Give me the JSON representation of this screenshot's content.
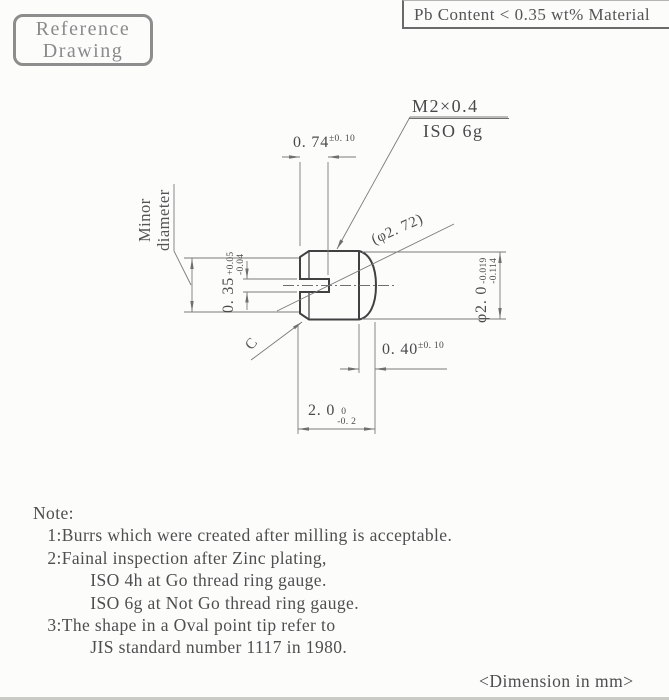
{
  "stamp": {
    "line1": "Reference",
    "line2": "Drawing"
  },
  "material_note": "Pb Content < 0.35 wt% Material",
  "thread": {
    "spec": "M2×0.4",
    "thread_class": "ISO 6g"
  },
  "dims": {
    "slot_depth": {
      "value": "0. 74",
      "tol": "±0. 10"
    },
    "tip_dia_ref": {
      "value": "(φ2. 72)"
    },
    "major_dia": {
      "value": "φ2. 0",
      "tol_upper": "-0.019",
      "tol_lower": "-0.114"
    },
    "slot_width": {
      "value": "0. 35",
      "tol_upper": "+0.05",
      "tol_lower": "-0.04"
    },
    "tip_length": {
      "value": "0. 40",
      "tol": "±0. 10"
    },
    "overall_length": {
      "value": "2. 0",
      "tol_upper": "0",
      "tol_lower": "-0. 2"
    },
    "minor_dia_label_line1": "Minor",
    "minor_dia_label_line2": "diameter",
    "chamfer_label": "C"
  },
  "notes": {
    "lines": [
      "Note:",
      "   1:Burrs which were created after milling is acceptable.",
      "   2:Fainal inspection after Zinc plating,",
      "            ISO 4h at Go thread ring gauge.",
      "            ISO 6g at Not Go thread ring gauge.",
      "   3:The shape in a Oval point tip refer to",
      "            JIS standard number 1117 in 1980."
    ]
  },
  "footer": "<Dimension in mm>",
  "colors": {
    "line": "#7a7a7a",
    "outline": "#414141",
    "stamp": "#8d8d8d",
    "text": "#4e4e4e"
  }
}
